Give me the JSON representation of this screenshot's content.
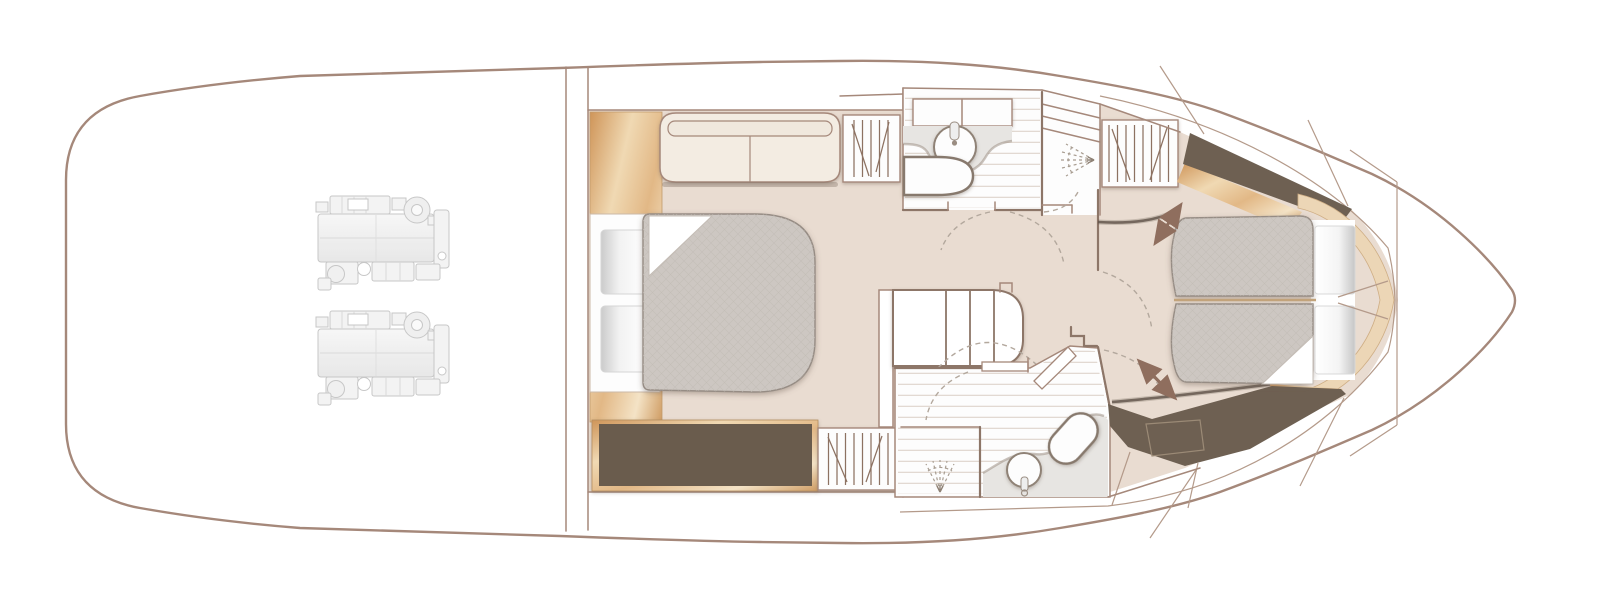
{
  "diagram": {
    "type": "yacht-deck-floorplan",
    "description": "Lower deck accommodation plan of a motor yacht, bow to the right, stern (engine room) to the left",
    "text_labels": []
  },
  "palette": {
    "hull_outline": "#a5887a",
    "wall_dark": "#8d7668",
    "floor_beige": "#e9dcd1",
    "room_white": "#fdfdfd",
    "plank_line": "#ddd3ca",
    "mattress_gray": "#cdc7c2",
    "cabinet_dark_brown": "#6e6052",
    "wood_tan": "#e2b886",
    "bow_trim_cream": "#ecd6b6",
    "counter_gray": "#e7e5e2",
    "engine_gray": "#c5c5c5",
    "arrow_brown": "#8f6e5e",
    "dashed_line": "#b3a89d"
  },
  "rooms": [
    {
      "id": "engine-room",
      "label": "Engine room (aft)",
      "fixtures": [
        "port-engine",
        "starboard-engine"
      ]
    },
    {
      "id": "midship-cabin",
      "label": "Midship double cabin",
      "fixtures": [
        "sofa",
        "hanging-locker-aft",
        "double-berth-mattress",
        "turned-down-corner",
        "two-pillows",
        "headboard",
        "wood-side-trim",
        "low-dark-cabinet",
        "hanging-locker-forward"
      ]
    },
    {
      "id": "midship-bathroom",
      "label": "Midship bathroom",
      "fixtures": [
        "vanity-cabinet",
        "round-washbasin",
        "toilet",
        "shower-compartment",
        "shelf-unit",
        "shower-spray-symbol",
        "door-swing-arcs"
      ]
    },
    {
      "id": "companionway",
      "label": "Companionway lobby with curved staircase",
      "fixtures": [
        "curved-staircase",
        "handrail-wall"
      ]
    },
    {
      "id": "forward-bathroom",
      "label": "Forward bathroom",
      "fixtures": [
        "shower-area",
        "shower-spray-symbol",
        "round-washbasin",
        "vanity-counter",
        "toilet",
        "door-leaf",
        "door-swing-arcs"
      ]
    },
    {
      "id": "forward-cabin",
      "label": "Forward cabin with island berth",
      "fixtures": [
        "split-double-mattress",
        "turned-down-corner",
        "two-pillows",
        "bed-slide-arrows",
        "hanging-locker",
        "dark-trim-panels",
        "bow-trim-band",
        "storage-hatch-outline"
      ]
    },
    {
      "id": "bow",
      "label": "Bow with hull seam lines and locker chord"
    }
  ],
  "annotations": {
    "double_headed_arrows": 2,
    "door_swing_style": "dashed quarter-circle arcs",
    "shower_symbol": "dashed spray fan"
  }
}
